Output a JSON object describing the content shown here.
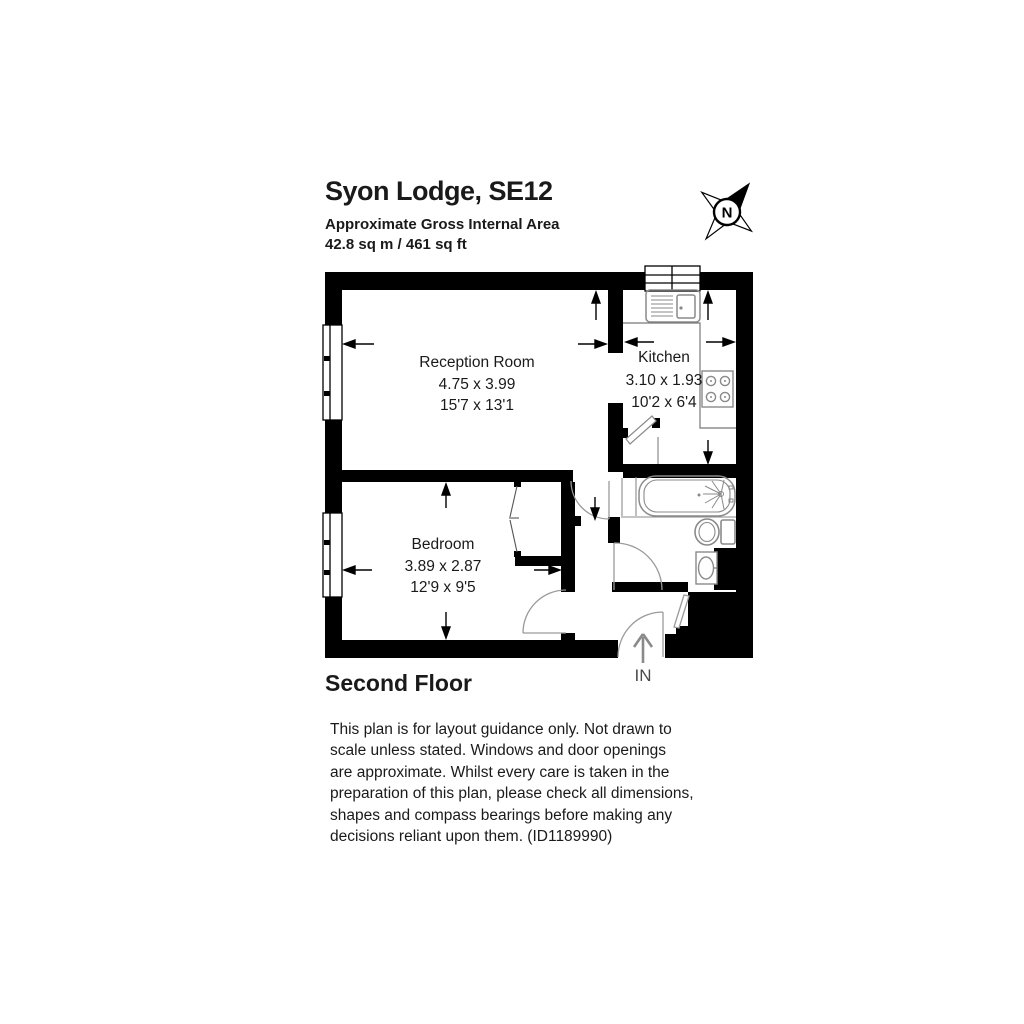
{
  "header": {
    "title": "Syon Lodge, SE12",
    "area_label": "Approximate Gross Internal Area",
    "area_value": "42.8 sq m / 461 sq ft"
  },
  "compass": {
    "north_label": "N"
  },
  "floor_plan": {
    "rooms": [
      {
        "name": "Reception Room",
        "dimensions_metric": "4.75 x 3.99",
        "dimensions_imperial": "15'7 x 13'1"
      },
      {
        "name": "Kitchen",
        "dimensions_metric": "3.10 x 1.93",
        "dimensions_imperial": "10'2 x 6'4"
      },
      {
        "name": "Bedroom",
        "dimensions_metric": "3.89 x 2.87",
        "dimensions_imperial": "12'9 x 9'5"
      }
    ],
    "entrance_label": "IN",
    "fixture_icons": [
      "sink-icon",
      "hob-icon",
      "bath-icon",
      "toilet-icon",
      "basin-icon",
      "wardrobe-icon",
      "window-icon",
      "door-arc-icon",
      "compass-rose-icon",
      "dimension-arrow-icon"
    ],
    "colors": {
      "walls": "#000000",
      "fixtures": "#8a8a8a",
      "doors": "#9a9a9a",
      "dimension_arrows": "#000000",
      "entrance_arrow": "#8a8a8a"
    }
  },
  "floor_label": "Second Floor",
  "disclaimer": {
    "lines": [
      "This plan is for layout guidance only. Not drawn to",
      "scale unless stated. Windows and door openings",
      "are approximate. Whilst every care is taken in the",
      "preparation of this plan, please check all dimensions,",
      "shapes and compass bearings before making any",
      "decisions reliant upon them. (ID1189990)"
    ]
  }
}
